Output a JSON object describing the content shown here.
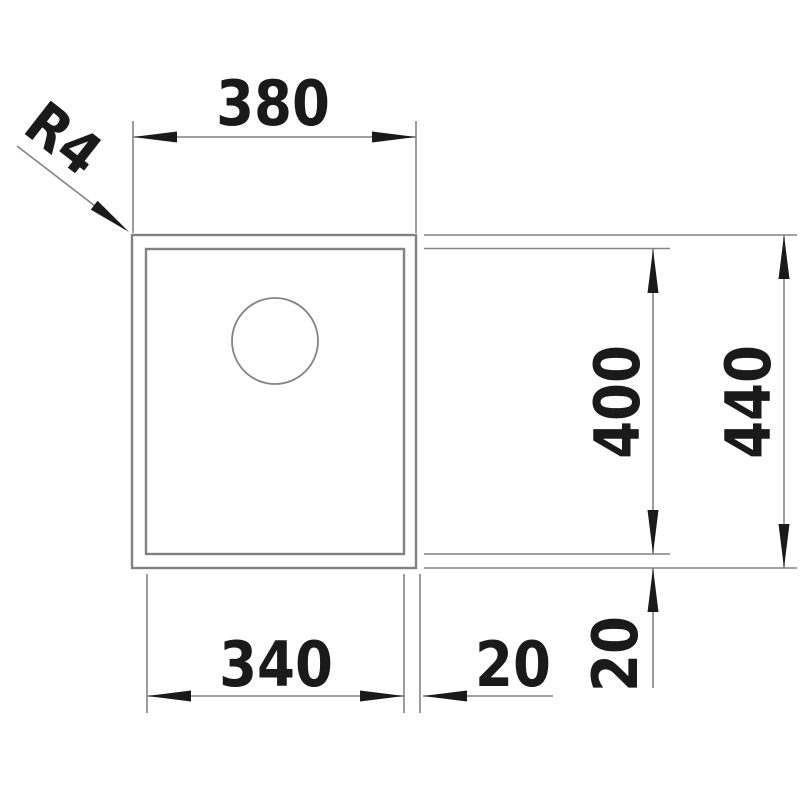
{
  "dimensions": {
    "overall_width": "380",
    "bowl_width": "340",
    "bowl_depth": "400",
    "overall_depth": "440",
    "side_offset": "20",
    "bottom_offset": "20",
    "corner_radius": "R4"
  },
  "colors": {
    "line_gray": "#828282",
    "ink_black": "#1a1a1a",
    "background": "#ffffff"
  }
}
